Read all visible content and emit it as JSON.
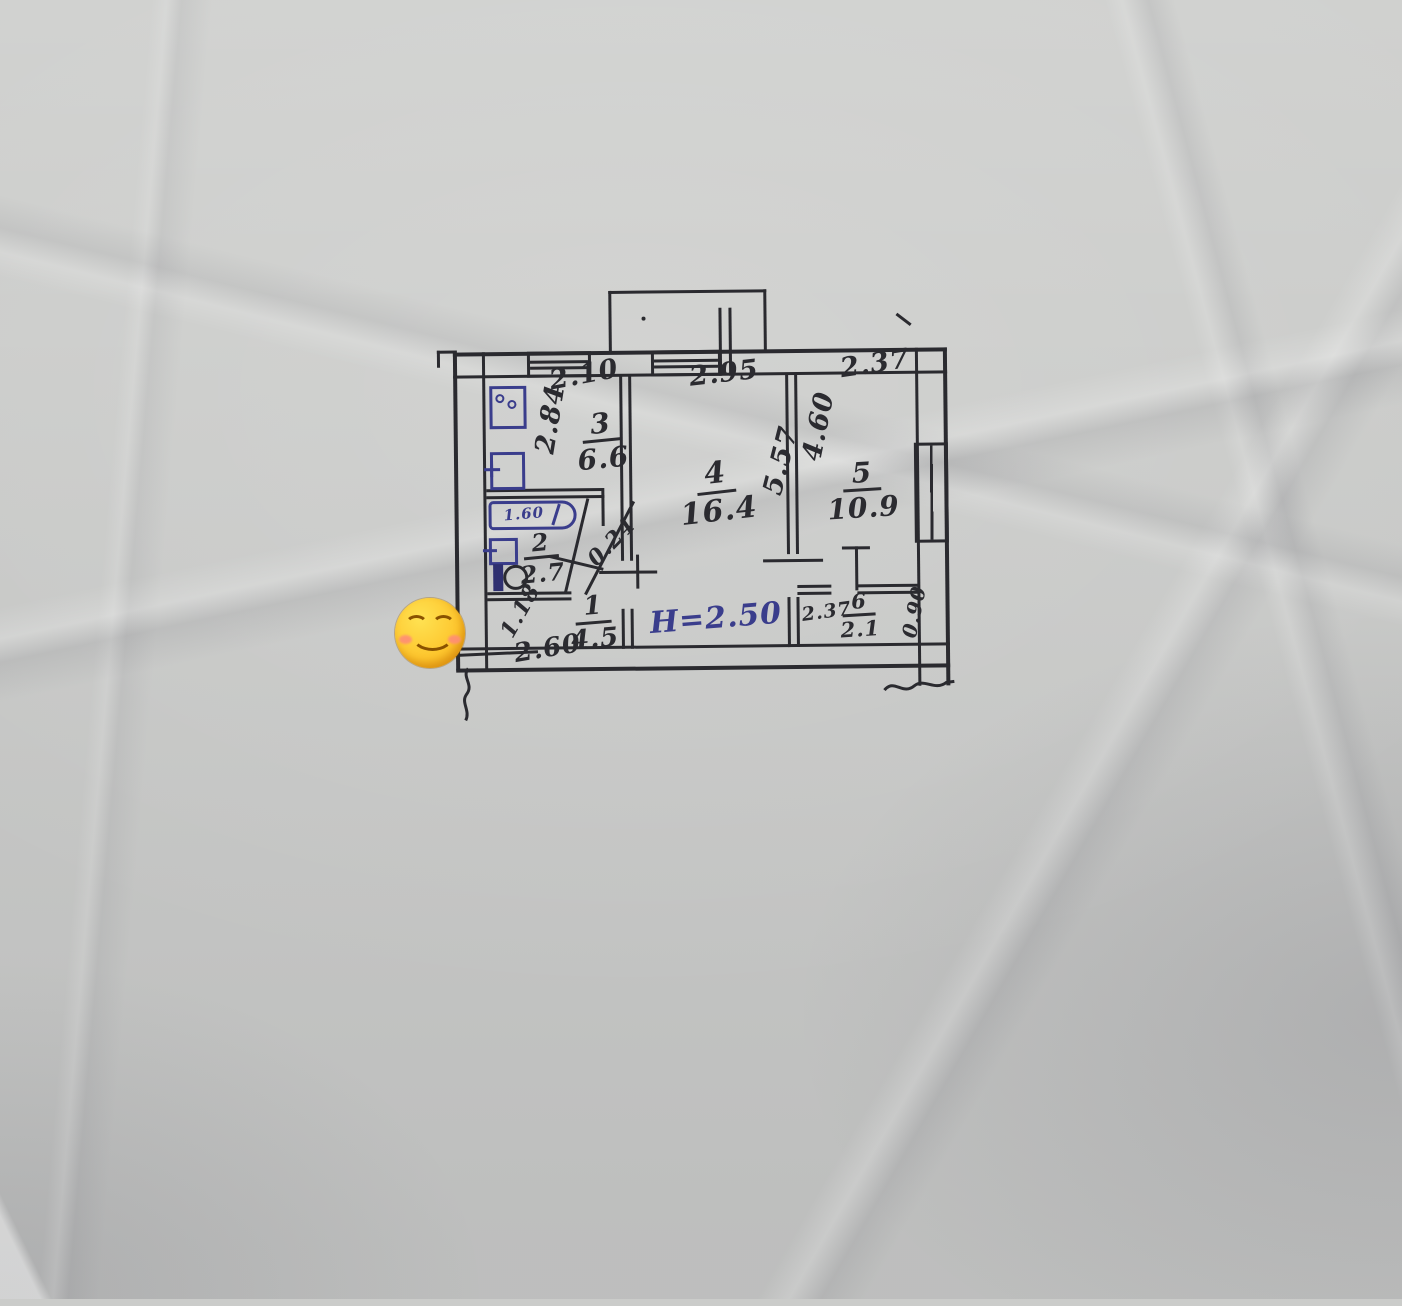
{
  "rooms": [
    {
      "number": "1",
      "area": "4.5"
    },
    {
      "number": "2",
      "area": "2.7"
    },
    {
      "number": "3",
      "area": "6.6"
    },
    {
      "number": "4",
      "area": "16.4"
    },
    {
      "number": "5",
      "area": "10.9"
    },
    {
      "number": "6",
      "area": "2.1"
    }
  ],
  "dimensions": {
    "kitchen_width": "2.10",
    "kitchen_depth": "2.84",
    "living_width": "2.95",
    "living_depth": "5.57",
    "bedroom_width": "2.37",
    "bedroom_depth": "4.60",
    "hall_width": "2.60",
    "hall_depth": "1.18",
    "bathtub_length": "1.60",
    "wall_offset": "0.24",
    "closet_width": "2.37",
    "closet_depth": "0.90"
  },
  "notes": {
    "ceiling_height": "H=2.50"
  },
  "colors": {
    "ink": "#2a2a2f",
    "pen_blue": "#3a3d8c",
    "paper": "#cbccca"
  },
  "emoji": {
    "name": "smiling-face-with-smiling-eyes"
  }
}
